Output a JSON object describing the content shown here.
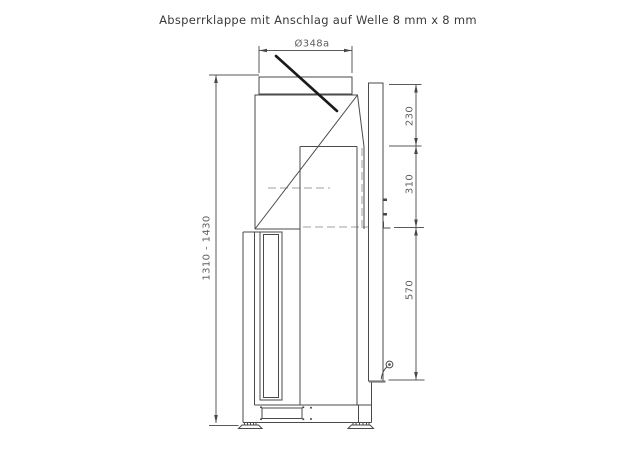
{
  "title": "Absperrklappe mit Anschlag auf Welle 8 mm x 8 mm",
  "drawing": {
    "view": "side-view-technical-drawing",
    "dimensions": {
      "diameter_top": "Ø348a",
      "height_range": "1310 - 1430",
      "right_chain": [
        "230",
        "310",
        "570"
      ]
    },
    "colors": {
      "line": "#4a4a4a",
      "dimension_line": "#5a5a5a",
      "dimension_text": "#5f5f5f",
      "title_text": "#3a3a3a",
      "hidden_line": "#9f9f9f",
      "flap_blade": "#1a1a1a",
      "background": "#ffffff"
    }
  }
}
